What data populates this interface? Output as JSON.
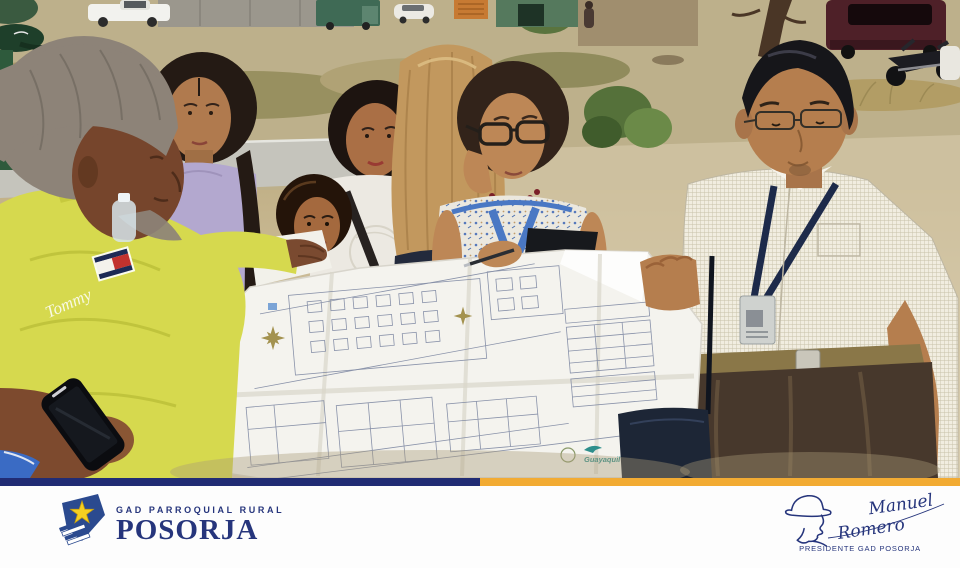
{
  "photo": {
    "shirt_script": "Tommy",
    "map_logo": "Guayaquil"
  },
  "footer": {
    "bar_blue": "#212c74",
    "bar_yellow": "#f2ab33",
    "logo": {
      "line1": "GAD PARROQUIAL RURAL",
      "name": "POSORJA",
      "shield_color": "#2b4a8f",
      "star_color": "#f5d022",
      "text_color": "#26357c"
    },
    "signature": {
      "first": "Manuel",
      "last": "Romero",
      "title": "PRESIDENTE GAD POSORJA",
      "ink_color": "#26357c"
    }
  }
}
